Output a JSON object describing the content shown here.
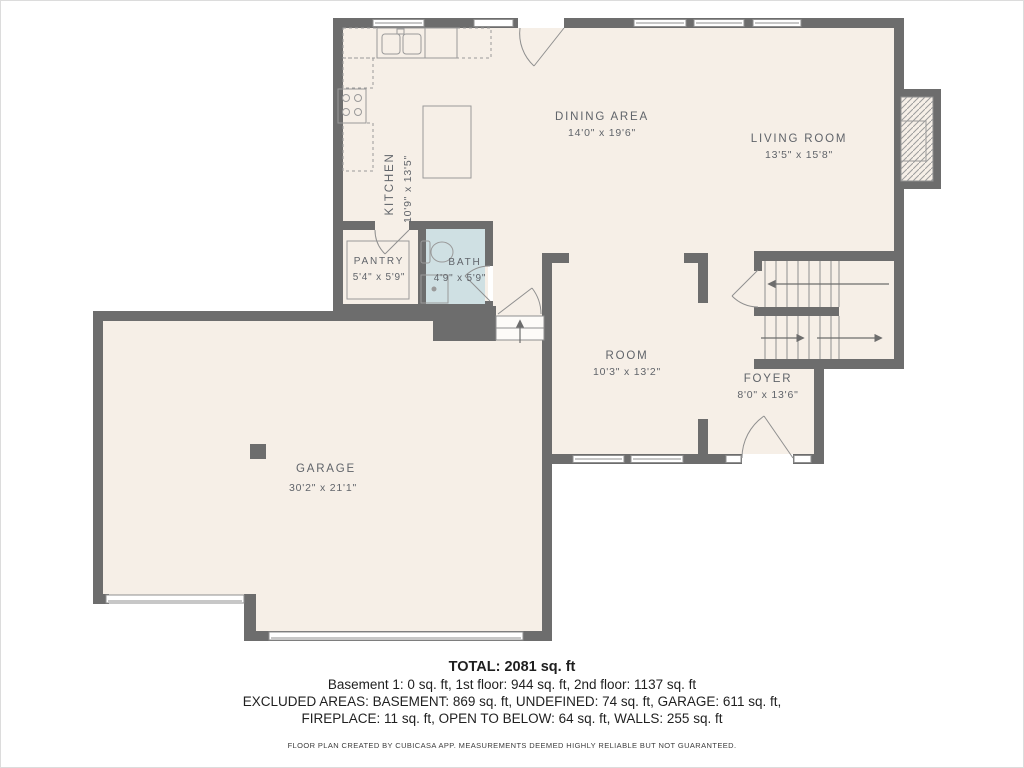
{
  "rooms": {
    "kitchen": {
      "name": "KITCHEN",
      "dims": "10'9\" x 13'5\""
    },
    "dining": {
      "name": "DINING AREA",
      "dims": "14'0\" x 19'6\""
    },
    "living": {
      "name": "LIVING ROOM",
      "dims": "13'5\" x 15'8\""
    },
    "pantry": {
      "name": "PANTRY",
      "dims": "5'4\" x 5'9\""
    },
    "bath": {
      "name": "BATH",
      "dims": "4'9\" x 5'9\""
    },
    "room": {
      "name": "ROOM",
      "dims": "10'3\" x 13'2\""
    },
    "foyer": {
      "name": "FOYER",
      "dims": "8'0\" x 13'6\""
    },
    "garage": {
      "name": "GARAGE",
      "dims": "30'2\" x 21'1\""
    }
  },
  "summary": {
    "total": "TOTAL: 2081 sq. ft",
    "floors": "Basement 1: 0 sq. ft, 1st floor: 944 sq. ft, 2nd floor: 1137 sq. ft",
    "excluded1": "EXCLUDED AREAS: BASEMENT: 869 sq. ft, UNDEFINED: 74 sq. ft, GARAGE: 611 sq. ft,",
    "excluded2": "FIREPLACE: 11 sq. ft, OPEN TO BELOW: 64 sq. ft, WALLS: 255 sq. ft",
    "disclaimer": "FLOOR PLAN CREATED BY CUBICASA APP. MEASUREMENTS DEEMED HIGHLY RELIABLE BUT NOT GUARANTEED."
  },
  "colors": {
    "wall": "#6d6d6d",
    "floor": "#f6efe7",
    "bath_floor": "#cfe0e3",
    "label": "#60646a"
  }
}
